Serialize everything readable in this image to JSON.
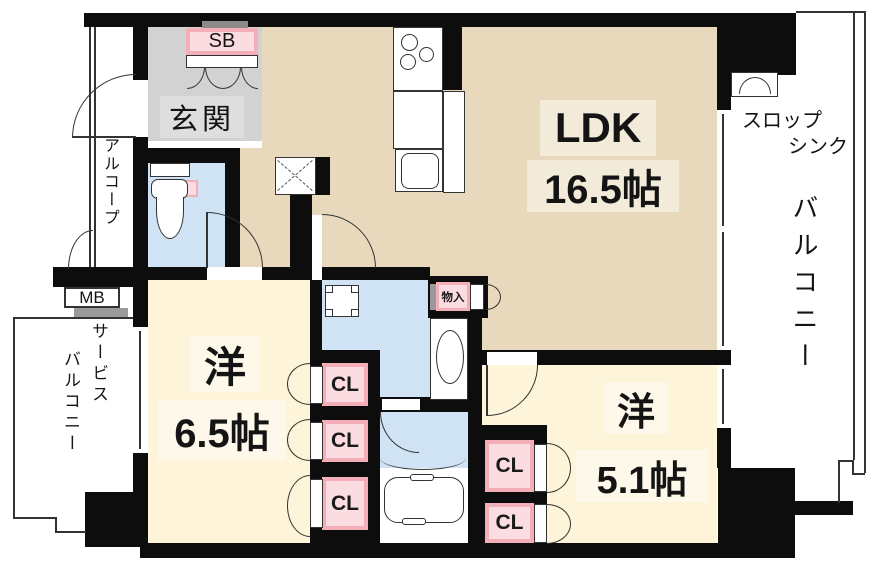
{
  "title": "apartment-floorplan",
  "palette": {
    "wall": "#0d0d0d",
    "ldk_floor": "#e8d9bd",
    "bedroom_floor": "#fdf4da",
    "wet_area_floor": "#cfe3f4",
    "entrance_floor": "#d2d2d2",
    "closet_pink": "#f3aeb8",
    "label_bg_ldk": "#f3ebd9",
    "label_bg_bedroom": "#fdf8e9"
  },
  "rooms": {
    "ldk": {
      "name": "LDK",
      "size": "16.5帖"
    },
    "west1": {
      "name": "洋",
      "size": "6.5帖"
    },
    "west2": {
      "name": "洋",
      "size": "5.1帖"
    },
    "entrance": {
      "name": "玄関"
    },
    "alcove": {
      "name": "アルコープ"
    },
    "balcony": {
      "name": "バルコニー"
    },
    "service_balcony": {
      "line1": "サービス",
      "line2": "バルコニー"
    },
    "slop_sink": {
      "line1": "スロップ",
      "line2": "シンク"
    },
    "storage": {
      "name": "物入"
    },
    "shoe_box": {
      "name": "SB"
    },
    "meter_box": {
      "name": "MB"
    }
  },
  "closets": [
    {
      "label": "CL"
    },
    {
      "label": "CL"
    },
    {
      "label": "CL"
    },
    {
      "label": "CL"
    },
    {
      "label": "CL"
    }
  ]
}
